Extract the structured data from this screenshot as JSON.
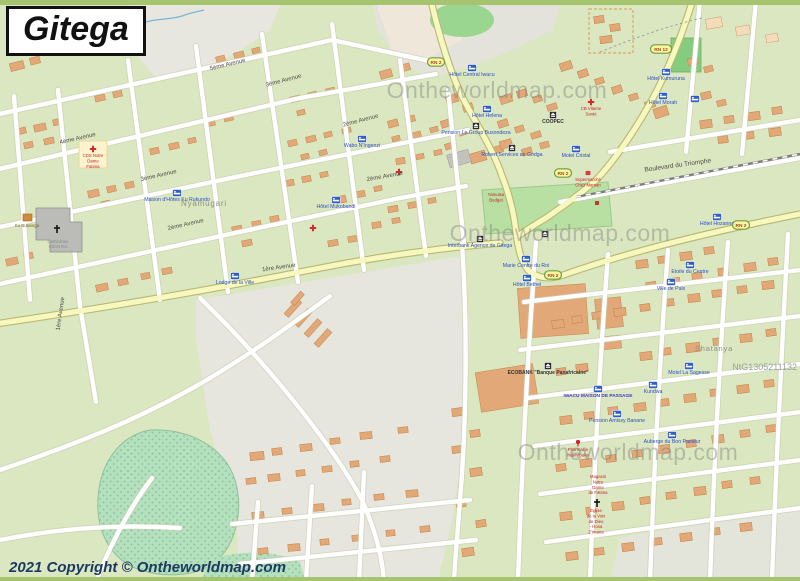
{
  "page": {
    "title": "Gitega",
    "copyright": "2021 Copyright © Ontheworldmap.com",
    "map_code": "NtG1305211132",
    "watermark_text": "Ontheworldmap.com"
  },
  "map": {
    "colors": {
      "land": "#dbe7c0",
      "building": "#e2a878",
      "road_major": "#f6f8c0",
      "park": "#b7e0a2",
      "poi_blue": "#2d4fc0",
      "poi_red": "#c42222",
      "badge": "#fbf3a0"
    },
    "area_labels": [
      {
        "label": "Nyamugari",
        "x": 204,
        "y": 206,
        "size": 8
      },
      {
        "label": "Shatanya",
        "x": 714,
        "y": 351,
        "size": 7.5
      }
    ],
    "street_labels": [
      {
        "label": "5ème Avenue",
        "x": 228,
        "y": 66,
        "rot": -14
      },
      {
        "label": "4ème Avenue",
        "x": 78,
        "y": 140,
        "rot": -13
      },
      {
        "label": "3ème Avenue",
        "x": 284,
        "y": 82,
        "rot": -15
      },
      {
        "label": "3ème Avenue",
        "x": 159,
        "y": 177,
        "rot": -13
      },
      {
        "label": "2ème Avenue",
        "x": 361,
        "y": 122,
        "rot": -15
      },
      {
        "label": "2ème Avenue",
        "x": 186,
        "y": 226,
        "rot": -13
      },
      {
        "label": "2ème Avenue",
        "x": 385,
        "y": 178,
        "rot": -10
      },
      {
        "label": "1ère Avenue",
        "x": 279,
        "y": 269,
        "rot": -8
      },
      {
        "label": "1ère Avenue",
        "x": 62,
        "y": 314,
        "rot": -82
      },
      {
        "label": "Boulevard du Triomphe",
        "x": 678,
        "y": 167,
        "rot": -8
      }
    ],
    "route_badges": [
      {
        "label": "RN 2",
        "x": 436,
        "y": 62
      },
      {
        "label": "RN 12",
        "x": 661,
        "y": 49
      },
      {
        "label": "RN 2",
        "x": 563,
        "y": 173
      },
      {
        "label": "RN 2",
        "x": 553,
        "y": 275
      },
      {
        "label": "RN 2",
        "x": 741,
        "y": 225
      }
    ],
    "watermarks": [
      {
        "x": 497,
        "y": 98
      },
      {
        "x": 560,
        "y": 241
      },
      {
        "x": 628,
        "y": 460
      }
    ],
    "pois": [
      {
        "label": "Hôtel Central Iwacu",
        "x": 472,
        "y": 76,
        "icon": "bed",
        "style": "blue"
      },
      {
        "label": "Hôtel Helena",
        "x": 487,
        "y": 117,
        "icon": "bed",
        "style": "blue"
      },
      {
        "label": "Pension Le Group Busondeza",
        "x": 476,
        "y": 134,
        "icon": "monument",
        "style": "blue"
      },
      {
        "label": "COOPEC",
        "x": 553,
        "y": 123,
        "icon": "bank",
        "style": "dark"
      },
      {
        "label": "Wabo N'Ingenzi",
        "x": 362,
        "y": 147,
        "icon": "bed",
        "style": "blue"
      },
      {
        "label": "Hôtel Mukobandi",
        "x": 336,
        "y": 208,
        "icon": "bed",
        "style": "blue"
      },
      {
        "label": "Maison d'Hôtes Ku Rukundo",
        "x": 177,
        "y": 201,
        "icon": "bed",
        "style": "blue"
      },
      {
        "label": "Lodge de la Ville",
        "x": 235,
        "y": 284,
        "icon": "bed",
        "style": "blue"
      },
      {
        "label": "Robert Services an Godga",
        "x": 512,
        "y": 156,
        "icon": "monument",
        "style": "blue"
      },
      {
        "label": "Motel Cristal",
        "x": 576,
        "y": 157,
        "icon": "bed",
        "style": "blue"
      },
      {
        "label": "Hôtel Kumuruna",
        "x": 666,
        "y": 80,
        "icon": "bed",
        "style": "blue"
      },
      {
        "label": "Hôtel Morah",
        "x": 663,
        "y": 104,
        "icon": "bed",
        "style": "blue"
      },
      {
        "label": "Hôtel Hozanna",
        "x": 717,
        "y": 225,
        "icon": "bed",
        "style": "blue"
      },
      {
        "label": "Etoile du Centre",
        "x": 690,
        "y": 273,
        "icon": "bed",
        "style": "blue"
      },
      {
        "label": "Ville de Paix",
        "x": 671,
        "y": 290,
        "icon": "bed",
        "style": "blue"
      },
      {
        "label": "Marie Centre du Roi",
        "x": 526,
        "y": 267,
        "icon": "bed",
        "style": "blue"
      },
      {
        "label": "Hôtel Bethel",
        "x": 527,
        "y": 286,
        "icon": "bed",
        "style": "blue"
      },
      {
        "label": "Interbank Agence de Gitega",
        "x": 480,
        "y": 247,
        "icon": "bank",
        "style": "blue"
      },
      {
        "label": "ECOBANK \"Banque Panafricaine\"",
        "x": 548,
        "y": 374,
        "icon": "bank",
        "style": "dark"
      },
      {
        "label": "IWACU MAISON DE PASSAGE",
        "x": 598,
        "y": 397,
        "icon": "bed",
        "style": "caps"
      },
      {
        "label": "Kundwa",
        "x": 653,
        "y": 393,
        "icon": "bed",
        "style": "blue"
      },
      {
        "label": "Motel La Sagesse",
        "x": 689,
        "y": 374,
        "icon": "bed",
        "style": "blue"
      },
      {
        "label": "Pension Amissy Banane",
        "x": 617,
        "y": 422,
        "icon": "bed",
        "style": "blue"
      },
      {
        "label": "Auberge du Bon Pasteur",
        "x": 672,
        "y": 443,
        "icon": "bed",
        "style": "blue"
      }
    ],
    "red_pois": [
      {
        "lines": [
          "CDS Notre",
          "Dame",
          "Fatima"
        ],
        "x": 93,
        "y": 157,
        "icon": "cross",
        "boxed": true
      },
      {
        "lines": [
          "CB Vitame",
          "Santé"
        ],
        "x": 591,
        "y": 110,
        "icon": "cross"
      },
      {
        "lines": [
          "Supermarché",
          "Chez Maman"
        ],
        "x": 588,
        "y": 181,
        "icon": "shop"
      },
      {
        "lines": [
          "Yamutsa",
          "Budget"
        ],
        "x": 496,
        "y": 196,
        "icon": "none"
      },
      {
        "lines": [
          "Pharmacie",
          "Ntavyibuka"
        ],
        "x": 578,
        "y": 451,
        "icon": "marker"
      },
      {
        "lines": [
          "Magasin",
          "Notre",
          "Dame",
          "de Fatima"
        ],
        "x": 598,
        "y": 478,
        "icon": "none"
      },
      {
        "lines": [
          "Église",
          "de la Voix",
          "de Dieu",
          "- Hosa",
          "Z'Imana"
        ],
        "x": 596,
        "y": 512,
        "icon": "none"
      }
    ],
    "misc_labels": [
      {
        "label": "Ku Butwinga",
        "x": 27,
        "y": 227,
        "color": "#7a5a30",
        "size": 4.3
      },
      {
        "label": "Cathédrale",
        "x": 58,
        "y": 243,
        "color": "#8a8a86",
        "size": 4.3
      },
      {
        "label": "Christ Roi",
        "x": 58,
        "y": 248,
        "color": "#8a8a86",
        "size": 4.3
      }
    ],
    "standalone_icons": [
      {
        "icon": "cross",
        "x": 399,
        "y": 172
      },
      {
        "icon": "cross",
        "x": 313,
        "y": 228
      },
      {
        "icon": "church-cross",
        "x": 57,
        "y": 229
      },
      {
        "icon": "church-cross",
        "x": 597,
        "y": 503
      },
      {
        "icon": "bed",
        "x": 695,
        "y": 99
      },
      {
        "icon": "bank",
        "x": 545,
        "y": 234
      }
    ]
  }
}
